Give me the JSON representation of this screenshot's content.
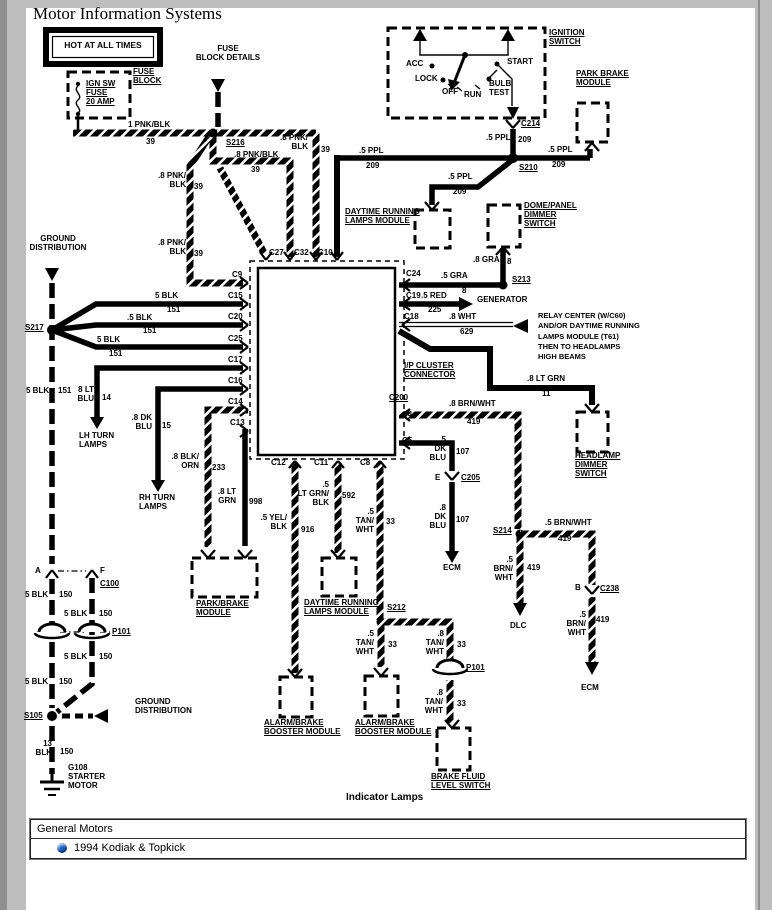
{
  "window": {
    "title": "Motor Information Systems"
  },
  "footer": {
    "header": "General Motors",
    "item": "1994 Kodiak & Topkick"
  },
  "colors": {
    "bullet": "#1e66c8"
  },
  "labels": [
    {
      "n": "hot-at-all-times",
      "t": "HOT AT ALL TIMES",
      "x": 53,
      "y": 41,
      "w": 100,
      "al": "c",
      "fs": 8.5
    },
    {
      "n": "fuse-block-details",
      "t": "FUSE\nBLOCK DETAILS",
      "x": 192,
      "y": 44,
      "w": 72,
      "al": "c"
    },
    {
      "n": "ign-sw-fuse",
      "t": "IGN SW\nFUSE\n20 AMP",
      "x": 86,
      "y": 79,
      "u": 1
    },
    {
      "n": "fuse-block",
      "t": "FUSE\nBLOCK",
      "x": 133,
      "y": 67,
      "u": 1
    },
    {
      "t": "1 PNK/BLK",
      "x": 128,
      "y": 120
    },
    {
      "t": "39",
      "x": 146,
      "y": 137
    },
    {
      "n": "splice-s216",
      "t": "S216",
      "x": 226,
      "y": 138,
      "u": 1
    },
    {
      "t": ".8 PNK/\nBLK",
      "x": 278,
      "y": 133,
      "w": 30,
      "al": "r"
    },
    {
      "t": "39",
      "x": 321,
      "y": 145
    },
    {
      "t": ".8 PNK/BLK",
      "x": 234,
      "y": 150
    },
    {
      "t": "39",
      "x": 251,
      "y": 165
    },
    {
      "t": ".8 PNK/\nBLK",
      "x": 155,
      "y": 171,
      "w": 31,
      "al": "r"
    },
    {
      "t": "39",
      "x": 194,
      "y": 182
    },
    {
      "t": ".8 PNK/\nBLK",
      "x": 155,
      "y": 238,
      "w": 31,
      "al": "r"
    },
    {
      "t": "39",
      "x": 194,
      "y": 249
    },
    {
      "n": "ignition-switch-label",
      "t": "IGNITION\nSWITCH",
      "x": 549,
      "y": 28,
      "u": 1
    },
    {
      "t": "ACC",
      "x": 406,
      "y": 59
    },
    {
      "t": "LOCK",
      "x": 415,
      "y": 74
    },
    {
      "t": "OFF",
      "x": 442,
      "y": 87
    },
    {
      "t": "RUN",
      "x": 464,
      "y": 90
    },
    {
      "t": "BULB\nTEST",
      "x": 489,
      "y": 79
    },
    {
      "t": "START",
      "x": 507,
      "y": 57
    },
    {
      "n": "conn-c214",
      "t": "C214",
      "x": 521,
      "y": 119,
      "u": 1
    },
    {
      "t": ".5 PPL",
      "x": 486,
      "y": 133
    },
    {
      "t": "209",
      "x": 518,
      "y": 135
    },
    {
      "n": "park-brake-module-label",
      "t": "PARK BRAKE\nMODULE",
      "x": 576,
      "y": 69,
      "u": 1
    },
    {
      "t": ".5 PPL",
      "x": 548,
      "y": 145
    },
    {
      "t": "209",
      "x": 552,
      "y": 160
    },
    {
      "t": ".5 PPL",
      "x": 359,
      "y": 146
    },
    {
      "t": "209",
      "x": 366,
      "y": 161
    },
    {
      "n": "splice-s210",
      "t": "S210",
      "x": 519,
      "y": 163,
      "u": 1
    },
    {
      "t": ".5 PPL",
      "x": 448,
      "y": 172
    },
    {
      "t": "209",
      "x": 453,
      "y": 187
    },
    {
      "n": "drl-module-top-label",
      "t": "DAYTIME RUNNING\nLAMPS MODULE",
      "x": 345,
      "y": 207,
      "u": 1
    },
    {
      "n": "dome-panel-dimmer-label",
      "t": "DOME/PANEL\nDIMMER\nSWITCH",
      "x": 524,
      "y": 201,
      "u": 1
    },
    {
      "t": ".8 GRA",
      "x": 473,
      "y": 255
    },
    {
      "t": "8",
      "x": 507,
      "y": 257
    },
    {
      "n": "splice-s213",
      "t": "S213",
      "x": 512,
      "y": 275,
      "u": 1
    },
    {
      "n": "ground-distribution-top",
      "t": "GROUND\nDISTRIBUTION",
      "x": 26,
      "y": 234,
      "w": 64,
      "al": "c"
    },
    {
      "n": "splice-s217",
      "t": "S217",
      "x": 25,
      "y": 323,
      "u": 1
    },
    {
      "t": "5 BLK",
      "x": 155,
      "y": 291
    },
    {
      "t": "151",
      "x": 167,
      "y": 305
    },
    {
      "t": ".5 BLK",
      "x": 127,
      "y": 313
    },
    {
      "t": "151",
      "x": 143,
      "y": 326
    },
    {
      "t": "5 BLK",
      "x": 97,
      "y": 335
    },
    {
      "t": "151",
      "x": 109,
      "y": 349
    },
    {
      "t": "5 BLK",
      "x": 26,
      "y": 386
    },
    {
      "t": "151",
      "x": 58,
      "y": 386
    },
    {
      "n": "conn-c9",
      "t": "C9",
      "x": 232,
      "y": 270
    },
    {
      "n": "conn-c15",
      "t": "C15",
      "x": 228,
      "y": 291
    },
    {
      "n": "conn-c20",
      "t": "C20",
      "x": 228,
      "y": 312
    },
    {
      "n": "conn-c25",
      "t": "C25",
      "x": 228,
      "y": 334
    },
    {
      "n": "conn-c17",
      "t": "C17",
      "x": 228,
      "y": 355
    },
    {
      "n": "conn-c16",
      "t": "C16",
      "x": 228,
      "y": 376
    },
    {
      "n": "conn-c14",
      "t": "C14",
      "x": 228,
      "y": 397
    },
    {
      "n": "conn-c13",
      "t": "C13",
      "x": 230,
      "y": 418
    },
    {
      "n": "conn-c27",
      "t": "C27",
      "x": 269,
      "y": 248
    },
    {
      "n": "conn-c32",
      "t": "C32",
      "x": 294,
      "y": 248
    },
    {
      "n": "conn-c10",
      "t": "C10",
      "x": 318,
      "y": 248
    },
    {
      "n": "conn-c24",
      "t": "C24",
      "x": 406,
      "y": 269
    },
    {
      "n": "conn-c19",
      "t": "C19",
      "x": 406,
      "y": 291
    },
    {
      "n": "conn-c18",
      "t": "C18",
      "x": 404,
      "y": 312
    },
    {
      "t": ".5 GRA",
      "x": 441,
      "y": 271
    },
    {
      "t": "8",
      "x": 462,
      "y": 286
    },
    {
      "t": ".5 RED",
      "x": 421,
      "y": 291
    },
    {
      "t": "225",
      "x": 428,
      "y": 305
    },
    {
      "n": "generator-label",
      "t": "GENERATOR",
      "x": 477,
      "y": 295
    },
    {
      "t": ".8 WHT",
      "x": 449,
      "y": 312
    },
    {
      "t": "629",
      "x": 460,
      "y": 327
    },
    {
      "n": "relay-note",
      "t": "RELAY CENTER (W/C60)\nAND/OR DAYTIME RUNNING\nLAMPS MODULE (T61)\nTHEN TO HEADLAMPS\nHIGH BEAMS",
      "x": 538,
      "y": 311,
      "fs": 7.5,
      "lh": 1.38
    },
    {
      "n": "ip-cluster-connector-label",
      "t": "I/P CLUSTER\nCONNECTOR",
      "x": 404,
      "y": 361,
      "u": 1
    },
    {
      "t": ".8 LT GRN",
      "x": 527,
      "y": 374
    },
    {
      "t": "11",
      "x": 542,
      "y": 389
    },
    {
      "n": "conn-c200",
      "t": "C200",
      "x": 389,
      "y": 393,
      "u": 1
    },
    {
      "n": "conn-c4",
      "t": "C4",
      "x": 402,
      "y": 410
    },
    {
      "n": "conn-c5",
      "t": "C5",
      "x": 402,
      "y": 436
    },
    {
      "t": ".8 BRN/WHT",
      "x": 449,
      "y": 399
    },
    {
      "t": "419",
      "x": 467,
      "y": 417
    },
    {
      "n": "headlamp-dimmer-label",
      "t": "HEADLAMP\nDIMMER\nSWITCH",
      "x": 575,
      "y": 451,
      "u": 1
    },
    {
      "n": "splice-s214",
      "t": "S214",
      "x": 493,
      "y": 526,
      "u": 1
    },
    {
      "t": ".5 BRN/WHT",
      "x": 545,
      "y": 518
    },
    {
      "t": "419",
      "x": 558,
      "y": 534
    },
    {
      "t": ".5\nBRN/\nWHT",
      "x": 488,
      "y": 555,
      "w": 25,
      "al": "r"
    },
    {
      "t": "419",
      "x": 527,
      "y": 563
    },
    {
      "n": "dlc-label",
      "t": "DLC",
      "x": 510,
      "y": 621
    },
    {
      "t": "B",
      "x": 575,
      "y": 583
    },
    {
      "n": "conn-c238",
      "t": "C238",
      "x": 600,
      "y": 584,
      "u": 1
    },
    {
      "t": ".5\nBRN/\nWHT",
      "x": 561,
      "y": 610,
      "w": 25,
      "al": "r"
    },
    {
      "t": "419",
      "x": 596,
      "y": 615
    },
    {
      "n": "ecm-right-label",
      "t": "ECM",
      "x": 581,
      "y": 683
    },
    {
      "t": "8 LT\nBLU",
      "x": 72,
      "y": 385,
      "w": 22,
      "al": "r"
    },
    {
      "t": "14",
      "x": 102,
      "y": 393
    },
    {
      "n": "lh-turn-lamps-label",
      "t": "LH TURN\nLAMPS",
      "x": 79,
      "y": 431
    },
    {
      "t": ".8 DK\nBLU",
      "x": 128,
      "y": 413,
      "w": 24,
      "al": "r"
    },
    {
      "t": "15",
      "x": 162,
      "y": 421
    },
    {
      "n": "rh-turn-lamps-label",
      "t": "RH TURN\nLAMPS",
      "x": 139,
      "y": 493
    },
    {
      "t": ".8 BLK/\nORN",
      "x": 170,
      "y": 452,
      "w": 29,
      "al": "r"
    },
    {
      "t": "233",
      "x": 212,
      "y": 463
    },
    {
      "t": ".8 LT\nGRN",
      "x": 212,
      "y": 487,
      "w": 24,
      "al": "r"
    },
    {
      "t": "998",
      "x": 249,
      "y": 497
    },
    {
      "n": "conn-c12",
      "t": "C12",
      "x": 271,
      "y": 458
    },
    {
      "n": "conn-c11",
      "t": "C11",
      "x": 314,
      "y": 458
    },
    {
      "n": "conn-c8",
      "t": "C8",
      "x": 360,
      "y": 458
    },
    {
      "t": ".5 YEL/\nBLK",
      "x": 258,
      "y": 513,
      "w": 29,
      "al": "r"
    },
    {
      "t": "916",
      "x": 301,
      "y": 525
    },
    {
      "t": ".5\nLT GRN/\nBLK",
      "x": 295,
      "y": 480,
      "w": 34,
      "al": "r"
    },
    {
      "t": "592",
      "x": 342,
      "y": 491
    },
    {
      "t": ".5\nTAN/\nWHT",
      "x": 350,
      "y": 507,
      "w": 24,
      "al": "r"
    },
    {
      "t": "33",
      "x": 386,
      "y": 517
    },
    {
      "t": ".5\nDK\nBLU",
      "x": 426,
      "y": 435,
      "w": 20,
      "al": "r"
    },
    {
      "t": "107",
      "x": 456,
      "y": 447
    },
    {
      "t": "E",
      "x": 435,
      "y": 473
    },
    {
      "n": "conn-c205",
      "t": "C205",
      "x": 461,
      "y": 473,
      "u": 1
    },
    {
      "t": ".8\nDK\nBLU",
      "x": 426,
      "y": 503,
      "w": 20,
      "al": "r"
    },
    {
      "t": "107",
      "x": 456,
      "y": 515
    },
    {
      "n": "ecm-mid-label",
      "t": "ECM",
      "x": 443,
      "y": 563
    },
    {
      "n": "park-brake-module2-label",
      "t": "PARK/BRAKE\nMODULE",
      "x": 196,
      "y": 599,
      "u": 1
    },
    {
      "n": "drl-module-bottom-label",
      "t": "DAYTIME RUNNING\nLAMPS MODULE",
      "x": 304,
      "y": 598,
      "u": 1
    },
    {
      "n": "splice-s212",
      "t": "S212",
      "x": 387,
      "y": 603,
      "u": 1
    },
    {
      "t": ".5\nTAN/\nWHT",
      "x": 350,
      "y": 629,
      "w": 24,
      "al": "r"
    },
    {
      "t": "33",
      "x": 388,
      "y": 640
    },
    {
      "t": ".8\nTAN/\nWHT",
      "x": 420,
      "y": 629,
      "w": 24,
      "al": "r"
    },
    {
      "t": "33",
      "x": 457,
      "y": 640
    },
    {
      "n": "grommet-p101b-label",
      "t": "P101",
      "x": 466,
      "y": 663,
      "u": 1
    },
    {
      "t": ".8\nTAN/\nWHT",
      "x": 419,
      "y": 688,
      "w": 24,
      "al": "r"
    },
    {
      "t": "33",
      "x": 457,
      "y": 699
    },
    {
      "n": "alarm-brake-left-label",
      "t": "ALARM/BRAKE\nBOOSTER MODULE",
      "x": 264,
      "y": 718,
      "u": 1
    },
    {
      "n": "alarm-brake-center-label",
      "t": "ALARM/BRAKE\nBOOSTER MODULE",
      "x": 355,
      "y": 718,
      "u": 1
    },
    {
      "n": "brake-fluid-label",
      "t": "BRAKE FLUID\nLEVEL SWITCH",
      "x": 431,
      "y": 772,
      "u": 1
    },
    {
      "t": "A",
      "x": 35,
      "y": 566
    },
    {
      "t": "F",
      "x": 100,
      "y": 566
    },
    {
      "n": "conn-c100",
      "t": "C100",
      "x": 100,
      "y": 579,
      "u": 1
    },
    {
      "t": "5 BLK",
      "x": 25,
      "y": 590
    },
    {
      "t": "150",
      "x": 59,
      "y": 590
    },
    {
      "t": "5 BLK",
      "x": 64,
      "y": 609
    },
    {
      "t": "150",
      "x": 99,
      "y": 609
    },
    {
      "n": "grommet-p101a-label",
      "t": "P101",
      "x": 112,
      "y": 627,
      "u": 1
    },
    {
      "t": "5 BLK",
      "x": 64,
      "y": 652
    },
    {
      "t": "150",
      "x": 99,
      "y": 652
    },
    {
      "t": "5 BLK",
      "x": 25,
      "y": 677
    },
    {
      "t": "150",
      "x": 59,
      "y": 677
    },
    {
      "n": "splice-s105",
      "t": "S105",
      "x": 24,
      "y": 711,
      "u": 1
    },
    {
      "n": "ground-distribution-bottom",
      "t": "GROUND\nDISTRIBUTION",
      "x": 135,
      "y": 697
    },
    {
      "t": "13\nBLK",
      "x": 32,
      "y": 739,
      "w": 20,
      "al": "r"
    },
    {
      "t": "150",
      "x": 60,
      "y": 747
    },
    {
      "n": "g108-starter-motor",
      "t": "G108\nSTARTER\nMOTOR",
      "x": 68,
      "y": 763
    },
    {
      "n": "diagram-caption",
      "t": "Indicator Lamps",
      "x": 346,
      "y": 792,
      "fs": 10
    }
  ]
}
